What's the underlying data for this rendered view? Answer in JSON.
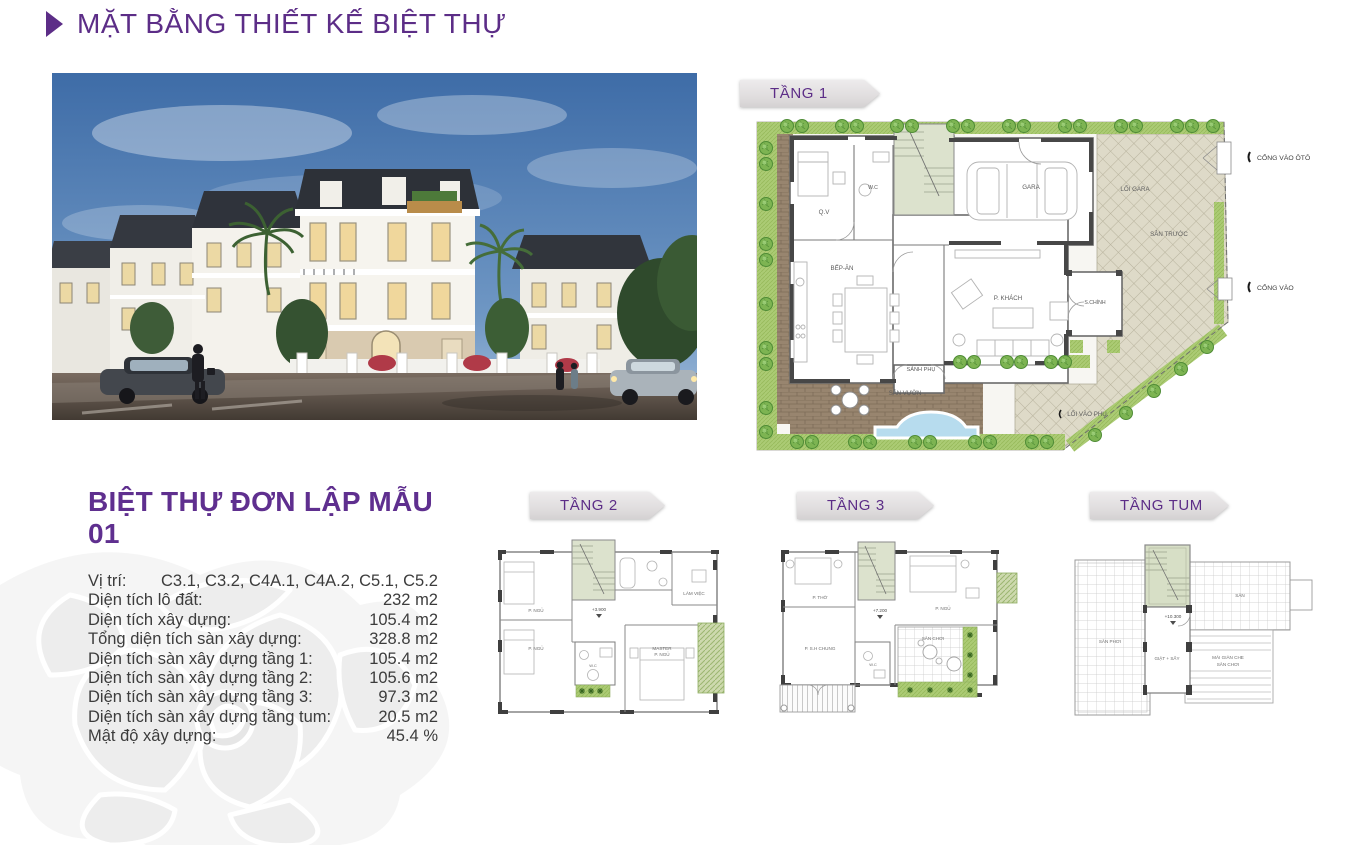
{
  "header": {
    "title": "MẶT BẰNG THIẾT KẾ BIỆT THỰ"
  },
  "villa": {
    "title": "BIỆT THỰ ĐƠN LẬP MẪU 01",
    "specs": [
      {
        "label": "Vị trí:",
        "value": "C3.1, C3.2, C4A.1, C4A.2, C5.1, C5.2"
      },
      {
        "label": "Diện tích lô đất:",
        "value": "232 m2"
      },
      {
        "label": "Diện tích xây dựng:",
        "value": "105.4 m2"
      },
      {
        "label": "Tổng diện tích sàn xây dựng:",
        "value": "328.8 m2"
      },
      {
        "label": "Diện tích sàn xây dựng tầng 1:",
        "value": "105.4 m2"
      },
      {
        "label": "Diện tích sàn xây dựng tầng 2:",
        "value": "105.6 m2"
      },
      {
        "label": "Diện tích sàn xây dựng tầng 3:",
        "value": "97.3 m2"
      },
      {
        "label": "Diện tích sàn xây dựng tầng tum:",
        "value": "20.5 m2"
      },
      {
        "label": "Mật độ xây dựng:",
        "value": "45.4 %"
      }
    ]
  },
  "floor_banners": {
    "t1": "TẦNG 1",
    "t2": "TẦNG 2",
    "t3": "TẦNG 3",
    "tum": "TẦNG TUM"
  },
  "plan_t1": {
    "labels": {
      "qv": "Q.V",
      "wc": "W.C",
      "bep": "BẾP-ĂN",
      "gara": "GARA",
      "pkhach": "P. KHÁCH",
      "schinh": "S.CHÍNH",
      "sanhphu": "SẢNH PHỤ",
      "sanvuon": "SÂN VƯỜN",
      "loigara": "LỐI GARA",
      "santruoc": "SÂN TRƯỚC",
      "loivaophu": "LỐI VÀO PHỤ",
      "congvaooto": "CỔNG VÀO ÔTÔ",
      "congvao": "CỔNG VÀO"
    }
  },
  "plan_t2": {
    "labels": {
      "pngu1": "P. NGỦ",
      "pngu2": "P. NGỦ",
      "master_l1": "MASTER",
      "master_l2": "P. NGỦ",
      "lamviec": "LÀM VIỆC",
      "wc": "W.C",
      "level": "+3.900"
    }
  },
  "plan_t3": {
    "labels": {
      "ptho": "P. THỜ",
      "pngu": "P. NGỦ",
      "pshchung": "P. S.H CHUNG",
      "wc": "W.C",
      "sanchoi": "SÂN CHƠI",
      "level": "+7.200"
    }
  },
  "plan_tum": {
    "labels": {
      "sanphoi": "SÂN PHƠI",
      "san": "SÂN",
      "giatsay": "GIẶT + SẤY",
      "maigianche_l1": "MÁI GIÀN CHE",
      "maigianche_l2": "SÂN CHƠI",
      "level": "+10.300"
    }
  },
  "colors": {
    "accent_purple": "#5c2d87",
    "banner_gray": "#e5e2e3",
    "lawn_green": "#abcb74",
    "paving_brown": "#98856f",
    "courtyard_beige": "#dedac8",
    "pool_blue": "#b7dcee",
    "stair_green": "#dce2cd"
  }
}
